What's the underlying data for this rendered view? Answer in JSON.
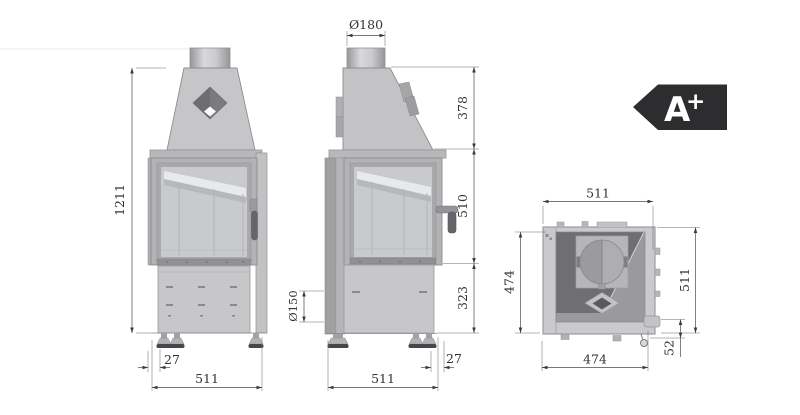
{
  "drawing": {
    "type": "fireplace-insert-technical-drawing",
    "views": [
      "front",
      "side",
      "top"
    ]
  },
  "energy_badge": {
    "letter": "A",
    "plus": "+"
  },
  "front_view": {
    "height": "1211",
    "foot_inset": "27",
    "width": "511"
  },
  "side_view": {
    "flue_diameter": "Ø180",
    "hood_height": "378",
    "door_height": "510",
    "base_height": "323",
    "intake_diameter": "Ø150",
    "foot_inset": "27",
    "depth": "511"
  },
  "top_view": {
    "width": "511",
    "body_depth": "474",
    "overall_depth": "511",
    "damper_offset": "52",
    "base_width": "474"
  },
  "colors": {
    "badge": "#2d2d2f",
    "body_gray": "#c7c7c9",
    "dark_interior": "#6f6f73",
    "dimension_line": "#4a4a4a"
  }
}
